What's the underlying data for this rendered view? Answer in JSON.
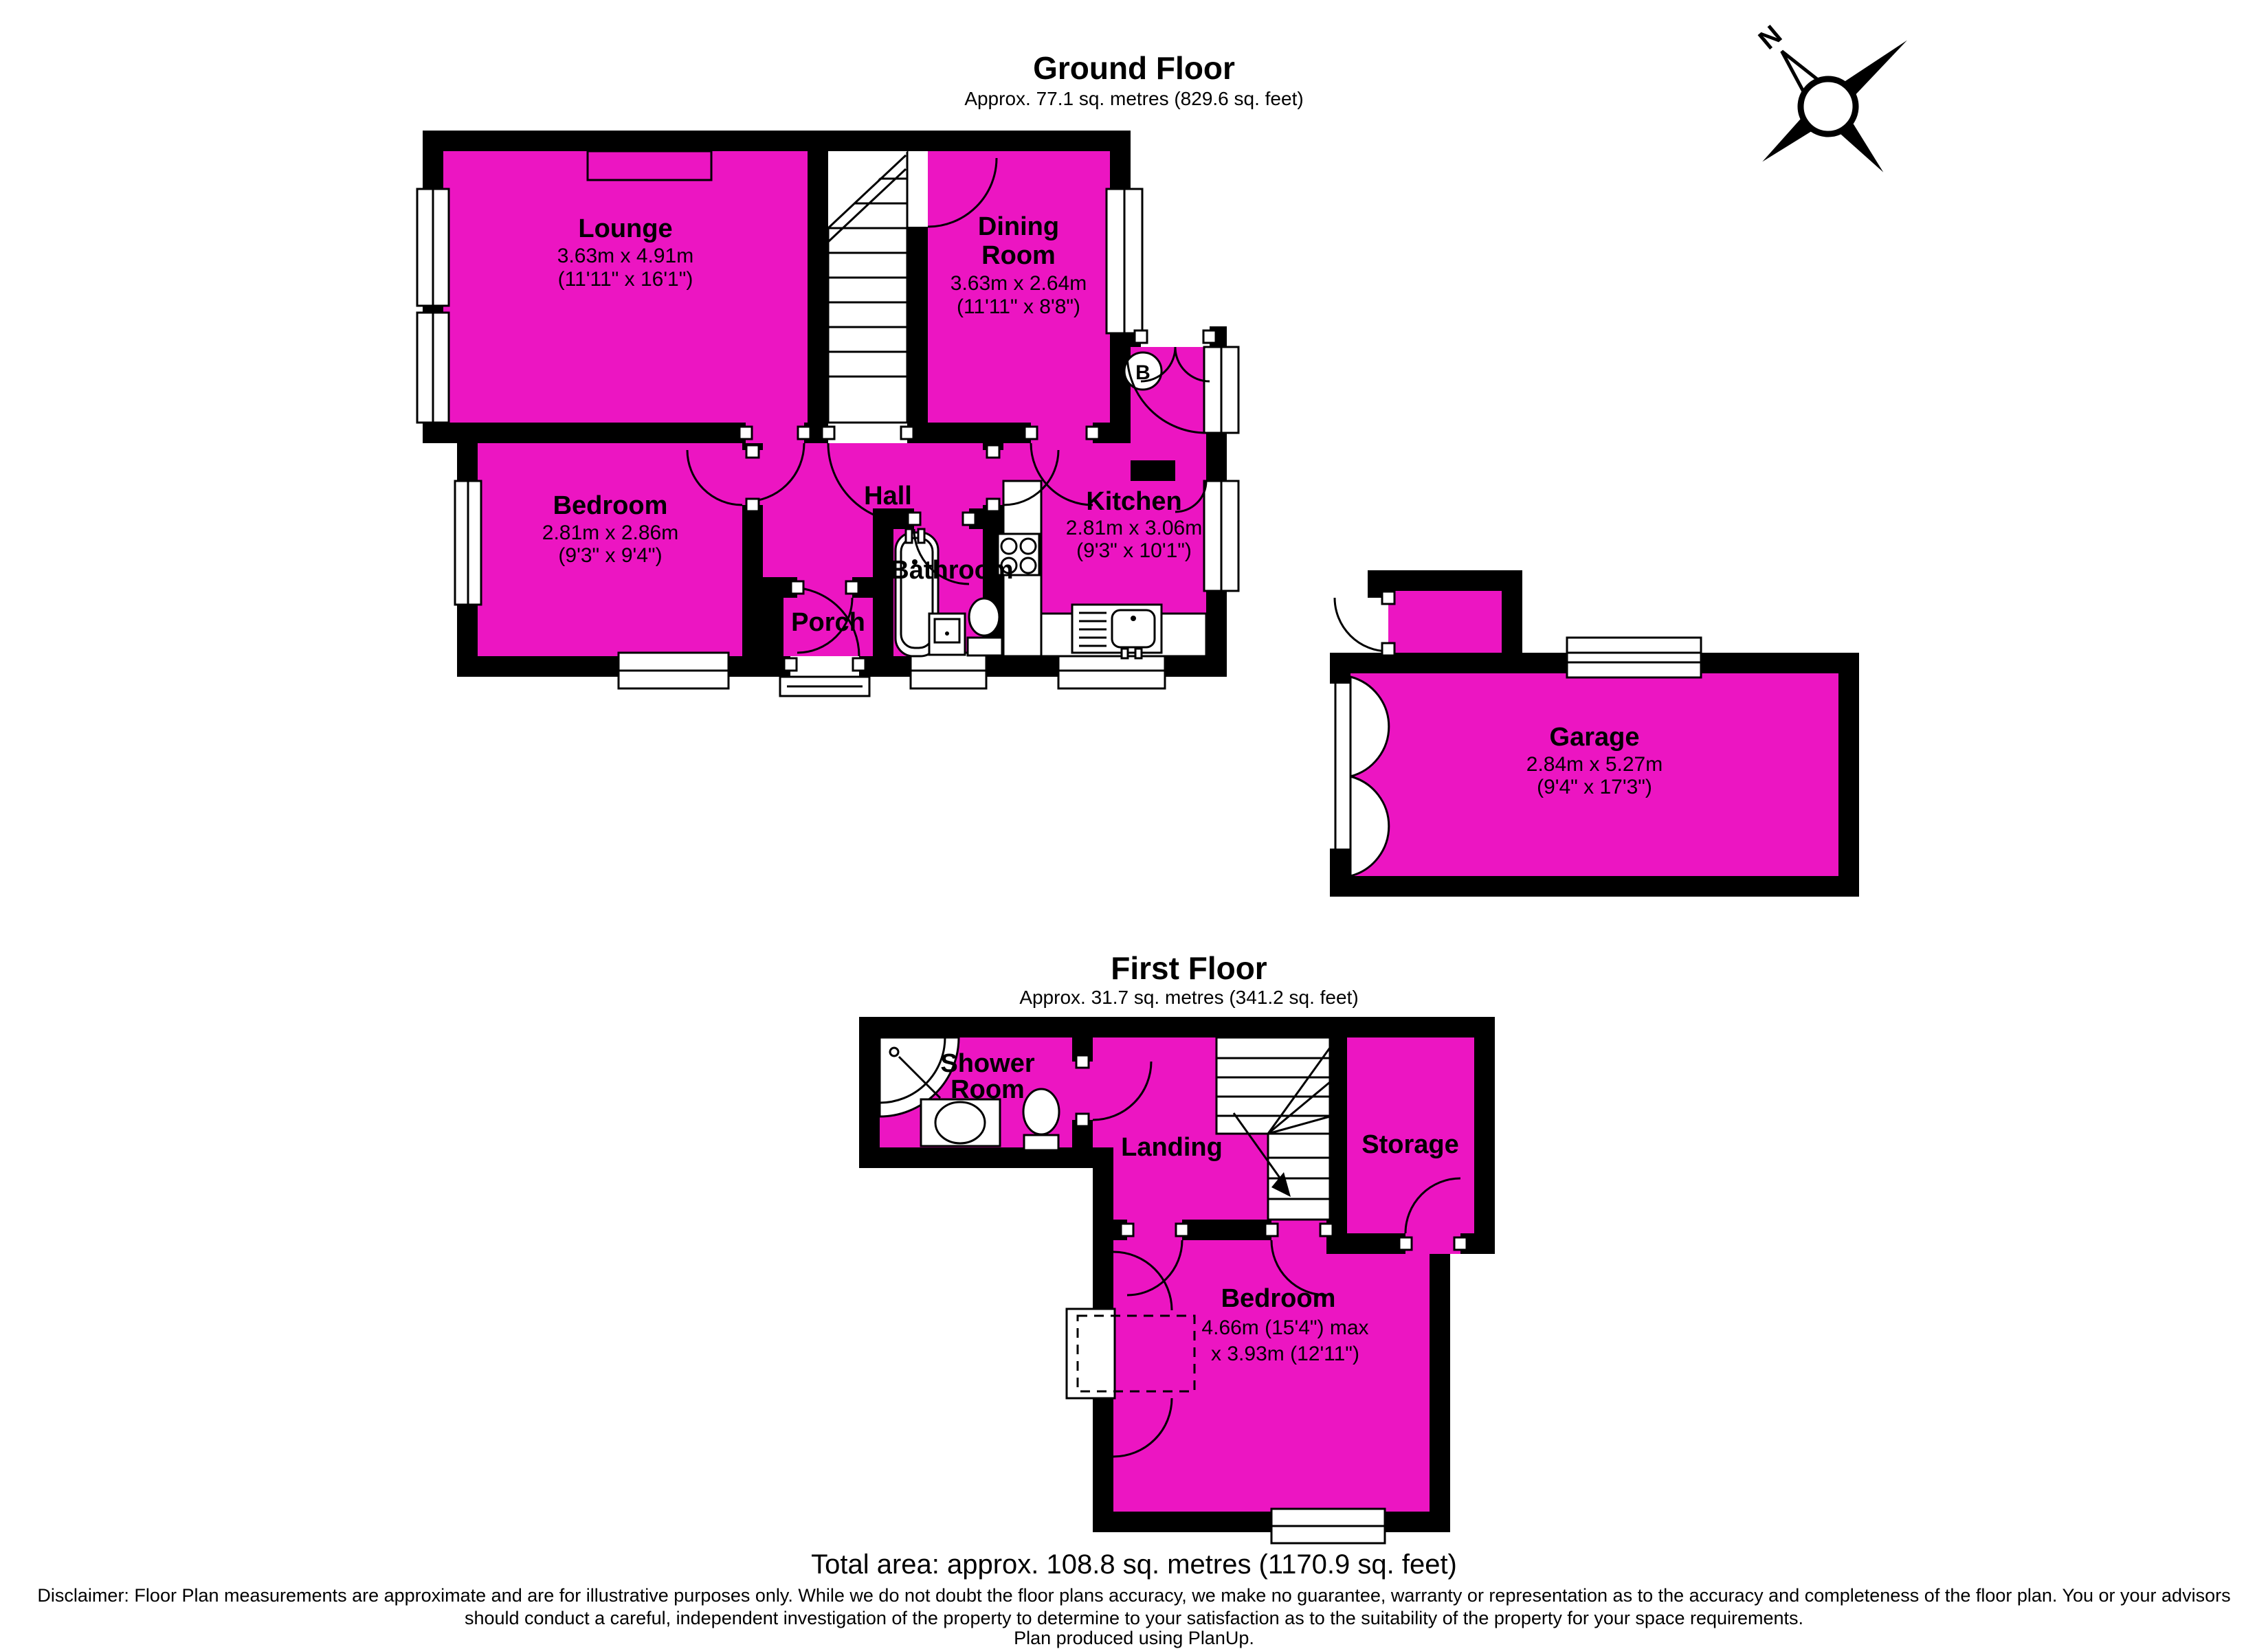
{
  "compass": {
    "north_label": "N"
  },
  "colors": {
    "room_fill": "#EC15C2",
    "wall": "#000000"
  },
  "ground_floor": {
    "title": "Ground Floor",
    "subtitle": "Approx. 77.1 sq. metres (829.6 sq. feet)",
    "boiler_label": "B",
    "rooms": {
      "lounge": {
        "name": "Lounge",
        "metric": "3.63m x 4.91m",
        "imperial": "(11'11\" x 16'1\")"
      },
      "dining_room": {
        "name_line1": "Dining",
        "name_line2": "Room",
        "metric": "3.63m x 2.64m",
        "imperial": "(11'11\" x 8'8\")"
      },
      "bedroom": {
        "name": "Bedroom",
        "metric": "2.81m x 2.86m",
        "imperial": "(9'3\" x 9'4\")"
      },
      "hall": {
        "name": "Hall"
      },
      "bathroom": {
        "name": "Bathroom"
      },
      "porch": {
        "name": "Porch"
      },
      "kitchen": {
        "name": "Kitchen",
        "metric": "2.81m x 3.06m",
        "imperial": "(9'3\" x 10'1\")"
      },
      "garage": {
        "name": "Garage",
        "metric": "2.84m x 5.27m",
        "imperial": "(9'4\" x 17'3\")"
      }
    }
  },
  "first_floor": {
    "title": "First Floor",
    "subtitle": "Approx. 31.7 sq. metres (341.2 sq. feet)",
    "rooms": {
      "shower_room": {
        "name_line1": "Shower",
        "name_line2": "Room"
      },
      "landing": {
        "name": "Landing"
      },
      "storage": {
        "name": "Storage"
      },
      "bedroom": {
        "name": "Bedroom",
        "metric_line1": "4.66m (15'4\") max",
        "metric_line2": "x 3.93m (12'11\")"
      }
    }
  },
  "footer": {
    "total_area": "Total area: approx. 108.8 sq. metres (1170.9 sq. feet)",
    "disclaimer": "Disclaimer:  Floor Plan measurements are approximate and are for illustrative purposes only.  While we do not doubt the floor plans accuracy, we make no guarantee, warranty or representation as to the accuracy and completeness of the floor plan.  You or your advisors should conduct a careful, independent investigation of the property to determine to your satisfaction as to the suitability of the property for your space requirements.",
    "produced": "Plan produced using PlanUp."
  }
}
